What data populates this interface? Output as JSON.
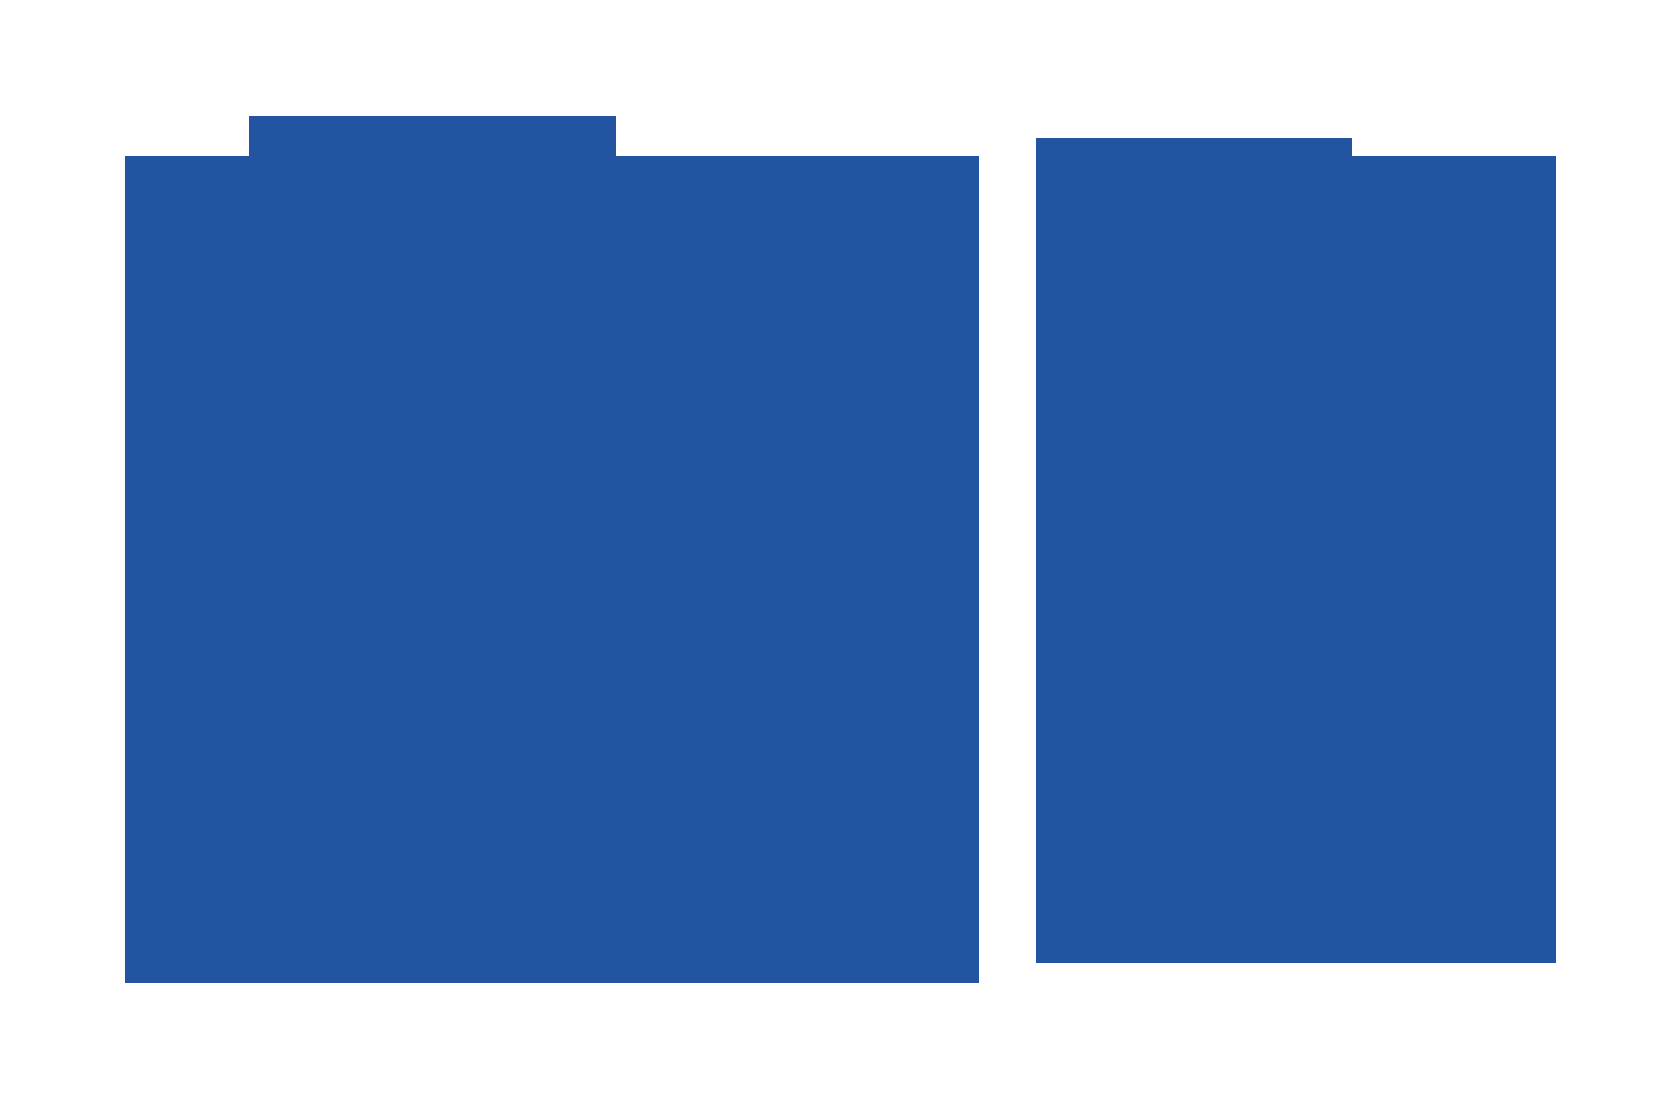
{
  "canvas": {
    "background_color": "#ffffff"
  },
  "shapes": {
    "left_folder": {
      "fill": "#2254A2"
    },
    "right_folder": {
      "fill": "#2254A2"
    }
  }
}
